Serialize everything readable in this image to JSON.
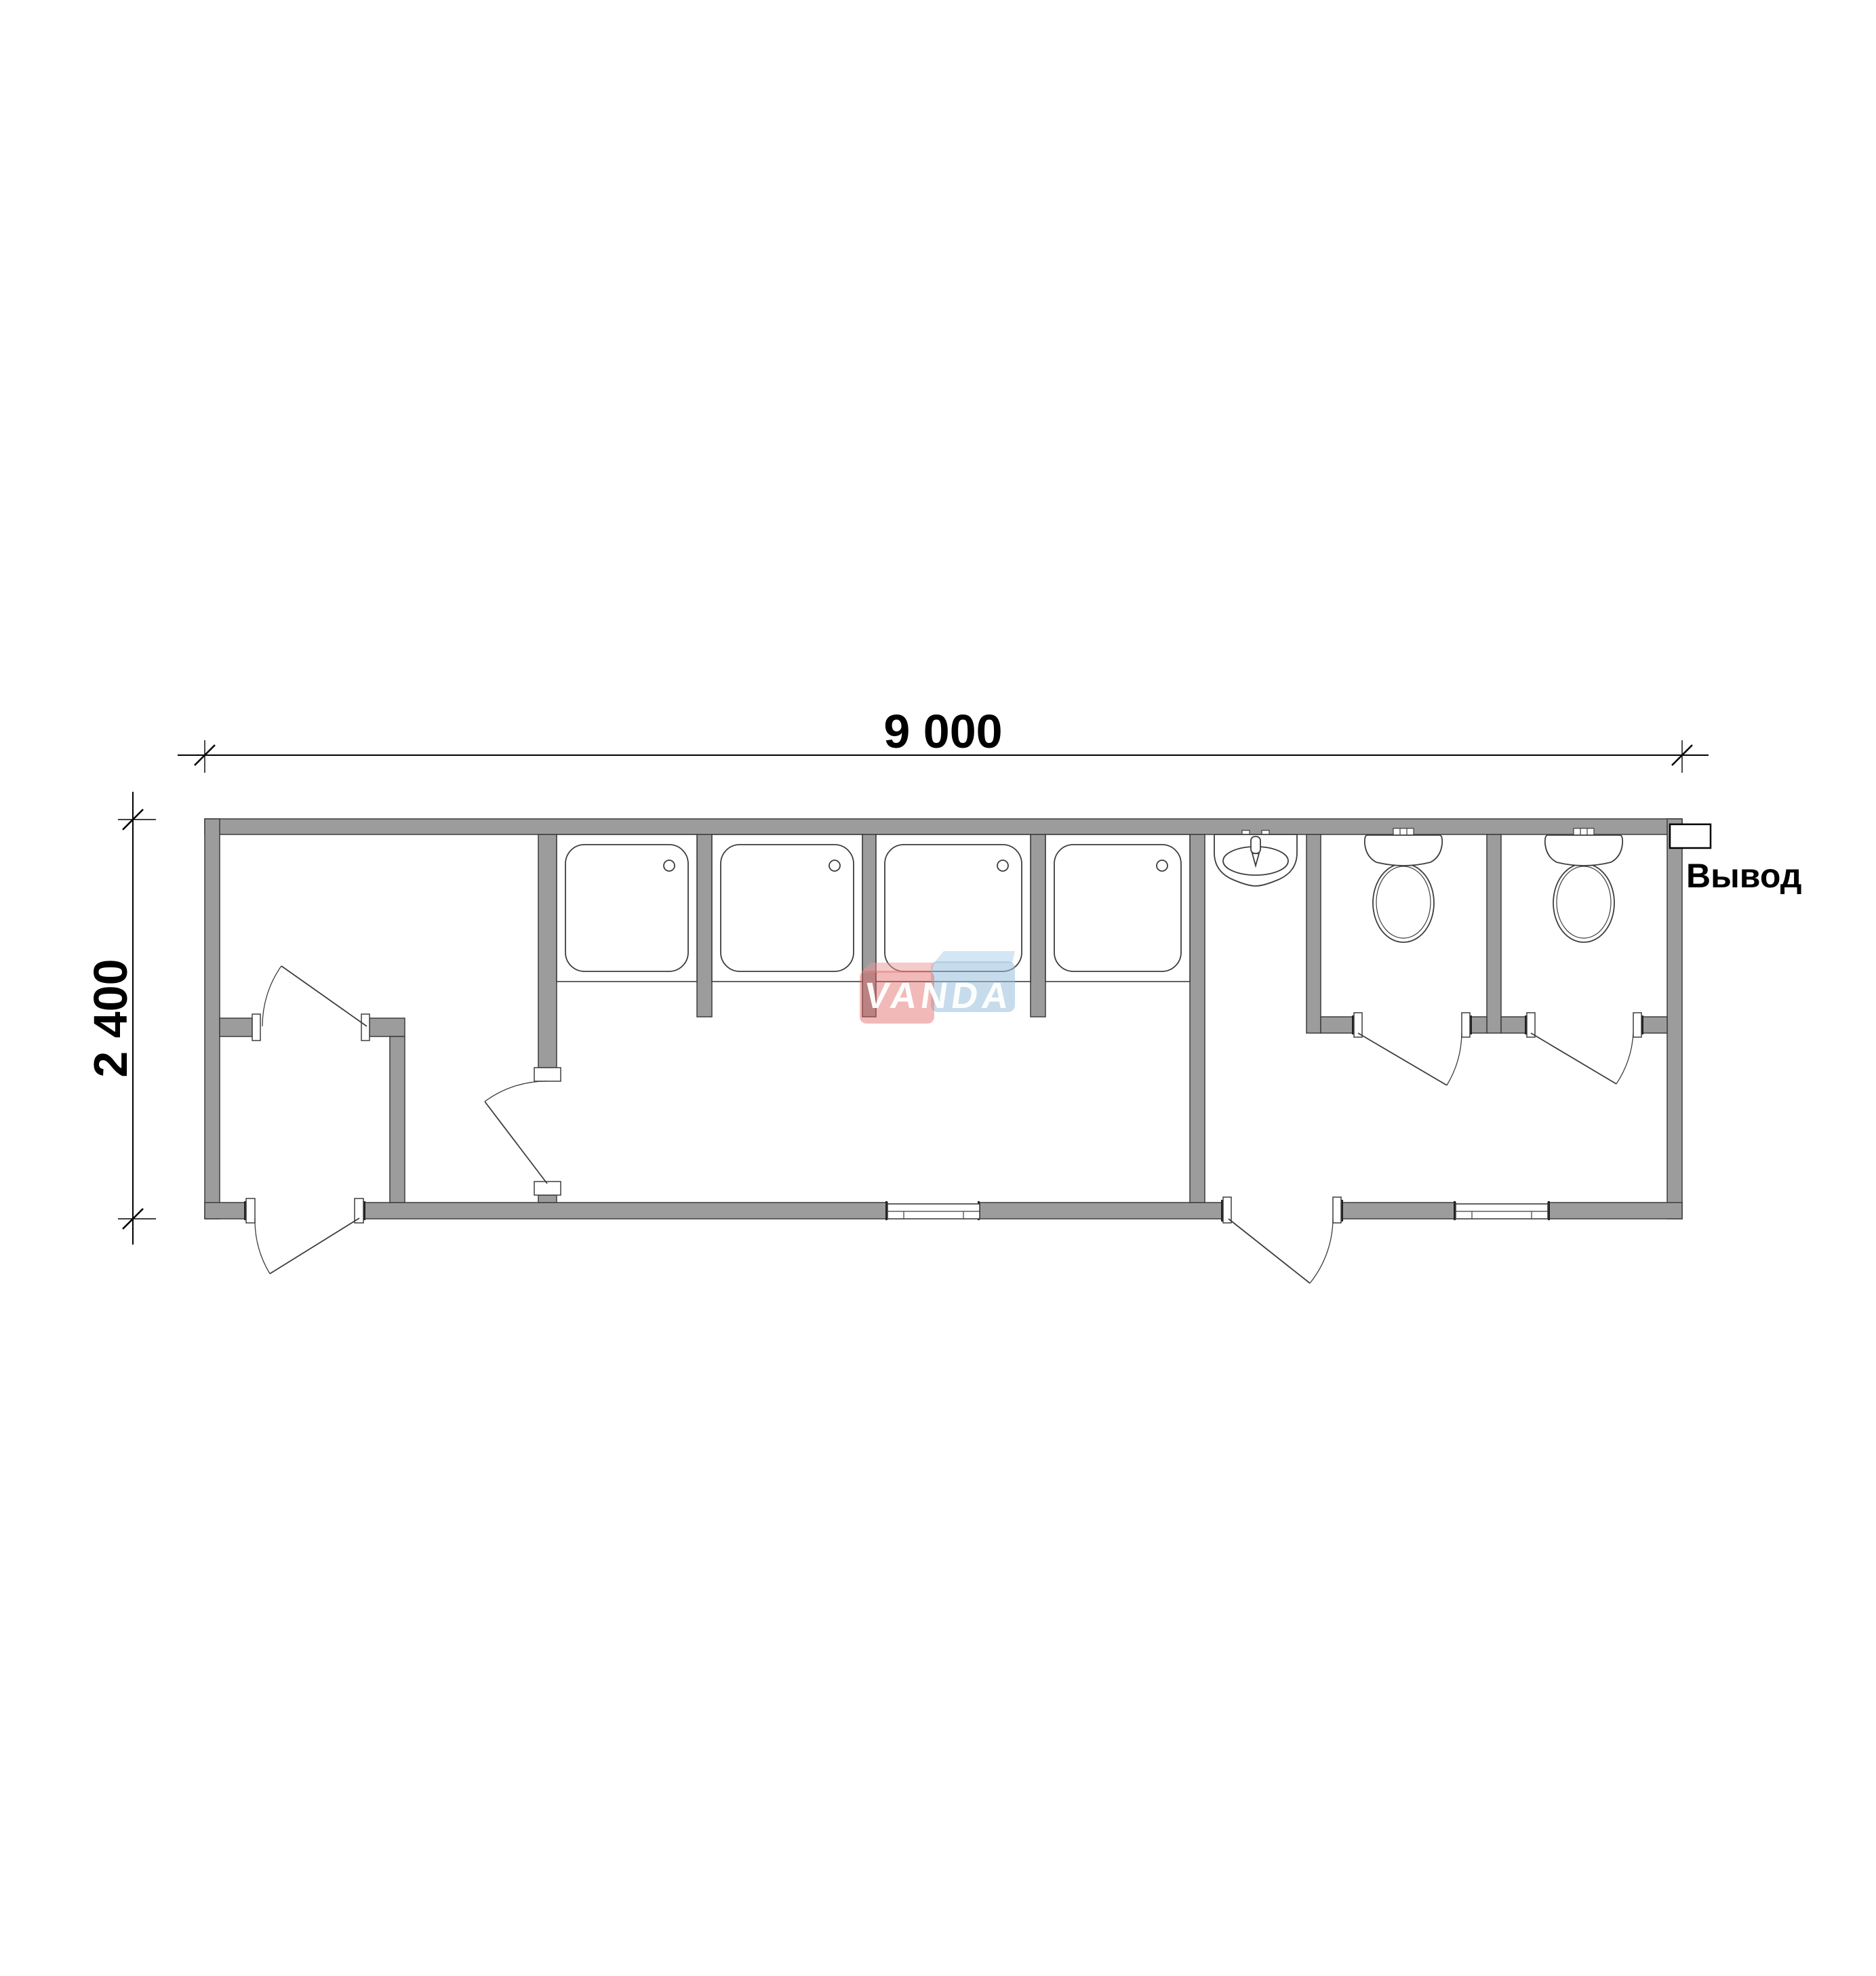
{
  "drawing": {
    "type": "modular sanitary container floor plan",
    "width_dimension": "9 000",
    "height_dimension": "2 400",
    "outlet_label": "Вывод",
    "watermark_text": "VANDA"
  },
  "fixtures": {
    "shower_cabins": 4,
    "toilets": 2,
    "sinks": 1,
    "exterior_doors": 2,
    "interior_doors": 4,
    "windows": 2
  },
  "colors": {
    "wall-fill": "#9c9c9c",
    "wall-stroke": "#3d3d3d",
    "line": "#3d3d3d",
    "dim": "#000000",
    "wm-red": "rgba(226,100,100,0.45)",
    "wm-red-lid": "rgba(236,150,150,0.5)",
    "wm-blue": "rgba(152,192,220,0.55)",
    "wm-blue-lid": "rgba(185,215,235,0.62)",
    "wm-text": "rgba(255,255,255,0.95)"
  }
}
